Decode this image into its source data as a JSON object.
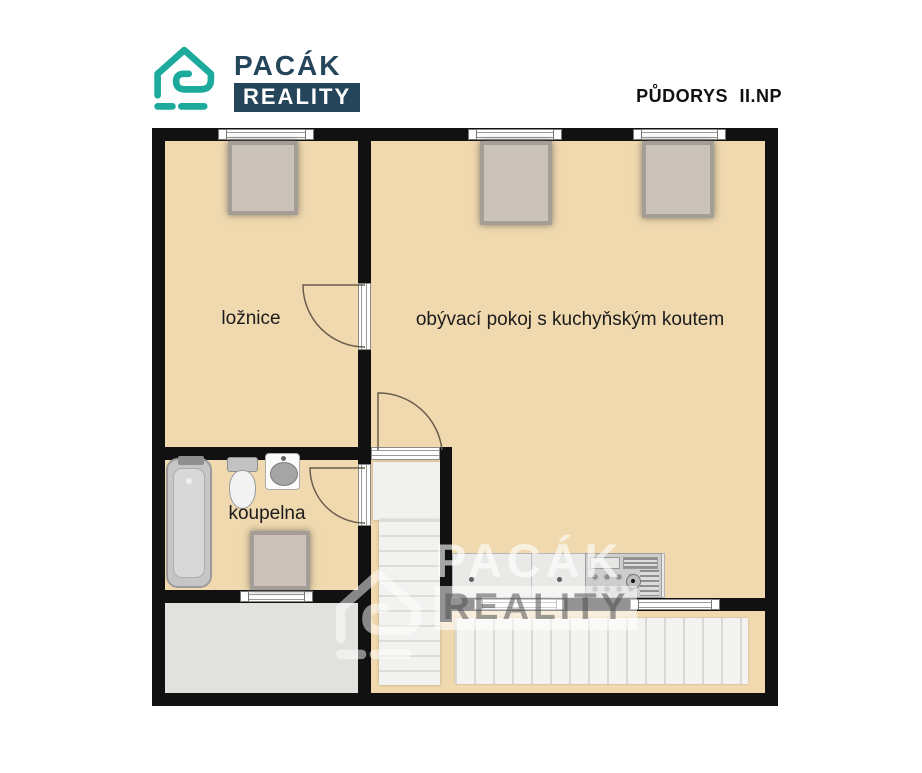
{
  "header": {
    "title": "PŮDORYS II.NP"
  },
  "logo": {
    "name": "PACÁK",
    "suffix": "REALITY"
  },
  "watermark": {
    "name": "PACÁK",
    "suffix": "REALITY"
  },
  "rooms": [
    {
      "label": "ložnice"
    },
    {
      "label": "obývací pokoj s kuchyňským koutem"
    },
    {
      "label": "koupelna"
    }
  ],
  "fixtures": [
    "bathtub",
    "toilet",
    "washbasin",
    "kitchen-counter",
    "cooker",
    "staircase",
    "roof-window",
    "window",
    "door",
    "terrace",
    "deck-planks"
  ],
  "colors": {
    "floor": "#f0d9af",
    "wall": "#111111",
    "terrace_floor": "#e1e2de",
    "logo_teal": "#1baa9b",
    "logo_navy": "#24455a"
  }
}
